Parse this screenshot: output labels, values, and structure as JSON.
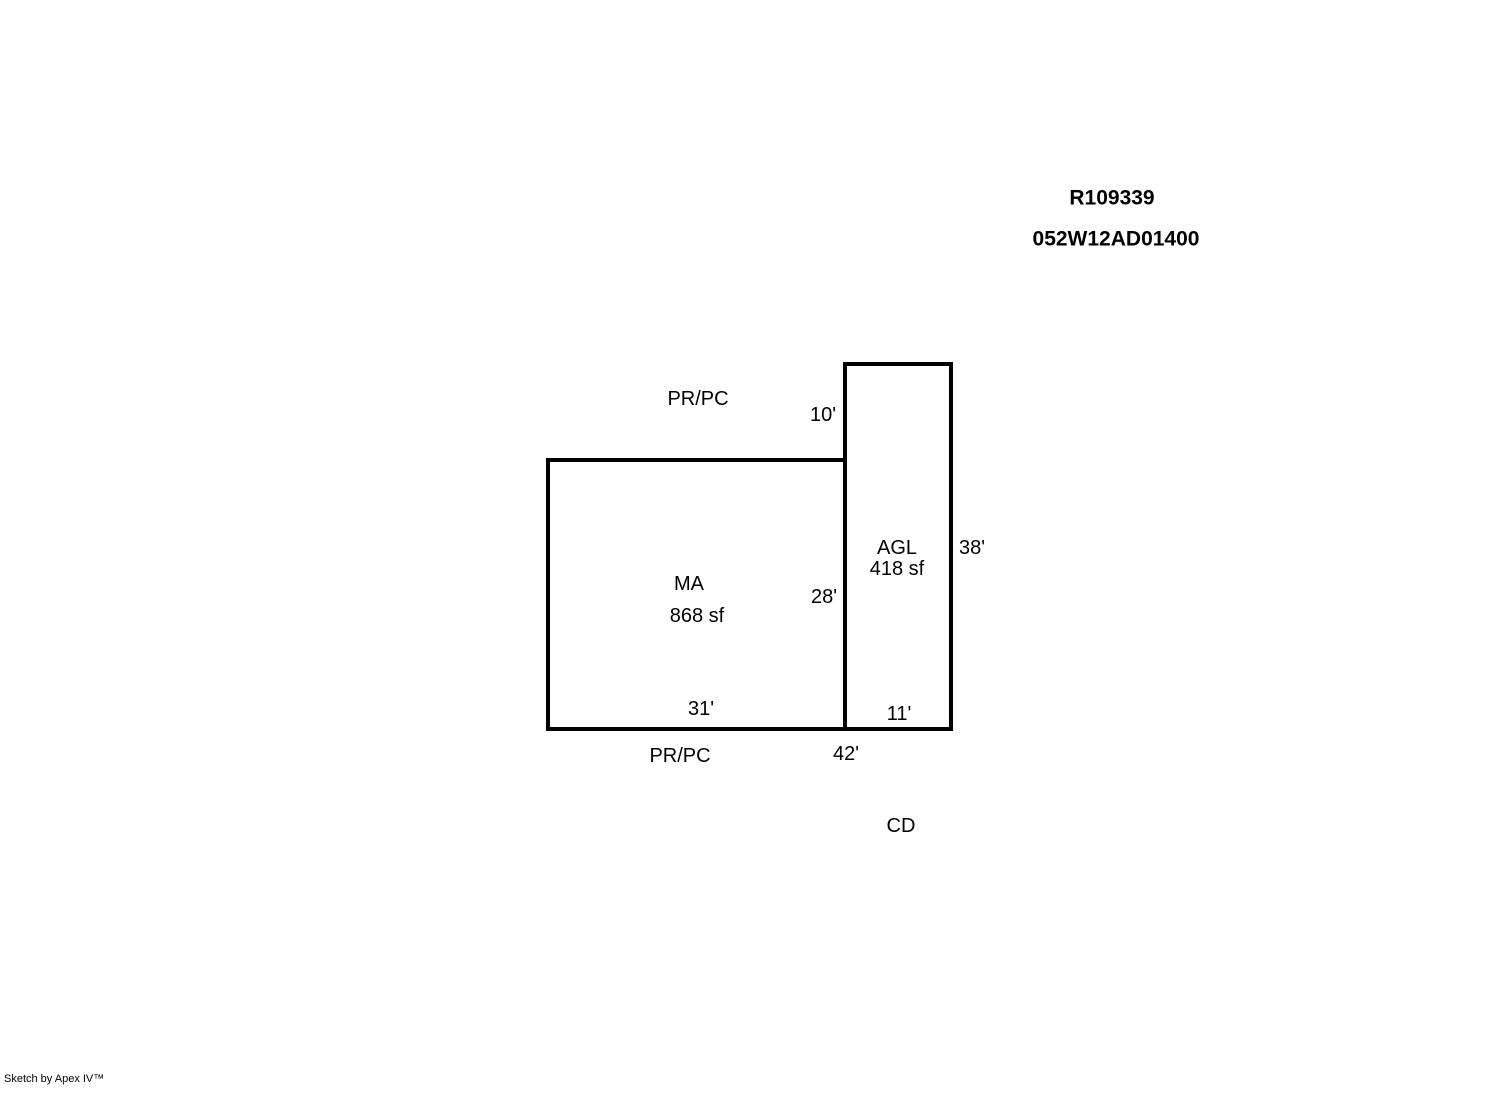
{
  "header": {
    "record_id": "R109339",
    "parcel_id": "052W12AD01400"
  },
  "sketch": {
    "ma": {
      "code": "MA",
      "area": "868 sf",
      "dim_right": "28'",
      "dim_bottom": "31'"
    },
    "agl": {
      "code": "AGL",
      "area": "418 sf",
      "dim_top": "10'",
      "dim_right": "38'",
      "dim_bottom": "11'"
    },
    "annotations": {
      "top_label": "PR/PC",
      "bottom_label": "PR/PC",
      "bottom_total": "42'",
      "cd_label": "CD"
    }
  },
  "footer": {
    "credit": "Sketch by Apex IV™"
  },
  "colors": {
    "background": "#ffffff",
    "line": "#000000"
  }
}
